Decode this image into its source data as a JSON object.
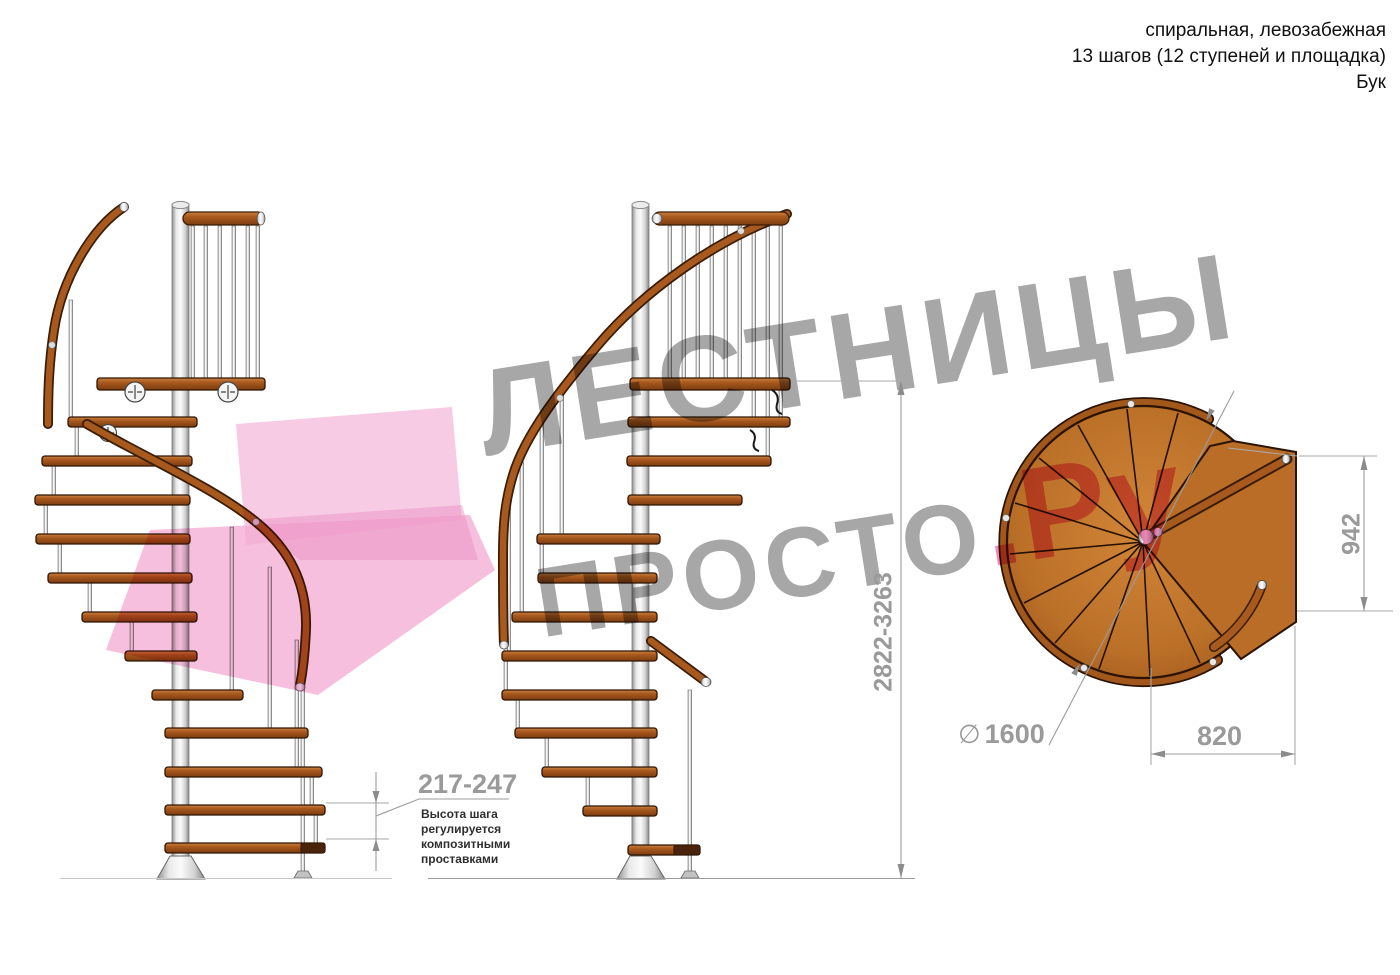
{
  "header": {
    "lines": [
      "спиральная, левозабежная",
      "13 шагов (12 ступеней и площадка)",
      "Бук"
    ]
  },
  "watermark": {
    "line1": "ЛЕСТНИЦЫ",
    "line2_gray": "ПРОСТО",
    "line2_pink": ".Ру"
  },
  "annotations": {
    "step_height": {
      "value": "217-247",
      "note": "Высота шага регулируется композитными проставками"
    },
    "total_height": {
      "value": "2822-3263"
    },
    "landing_width": {
      "value": "942"
    },
    "diameter": {
      "symbol": "∅",
      "value": "1600"
    },
    "landing_depth": {
      "value": "820"
    }
  },
  "colors": {
    "wood": "#a85a1e",
    "wood_dark": "#5a2d0c",
    "metal": "#d9d9d9",
    "watermark_gray": "#a0a0a0",
    "watermark_pink": "#ee7fb4",
    "dimension_gray": "#9a9a9a"
  }
}
